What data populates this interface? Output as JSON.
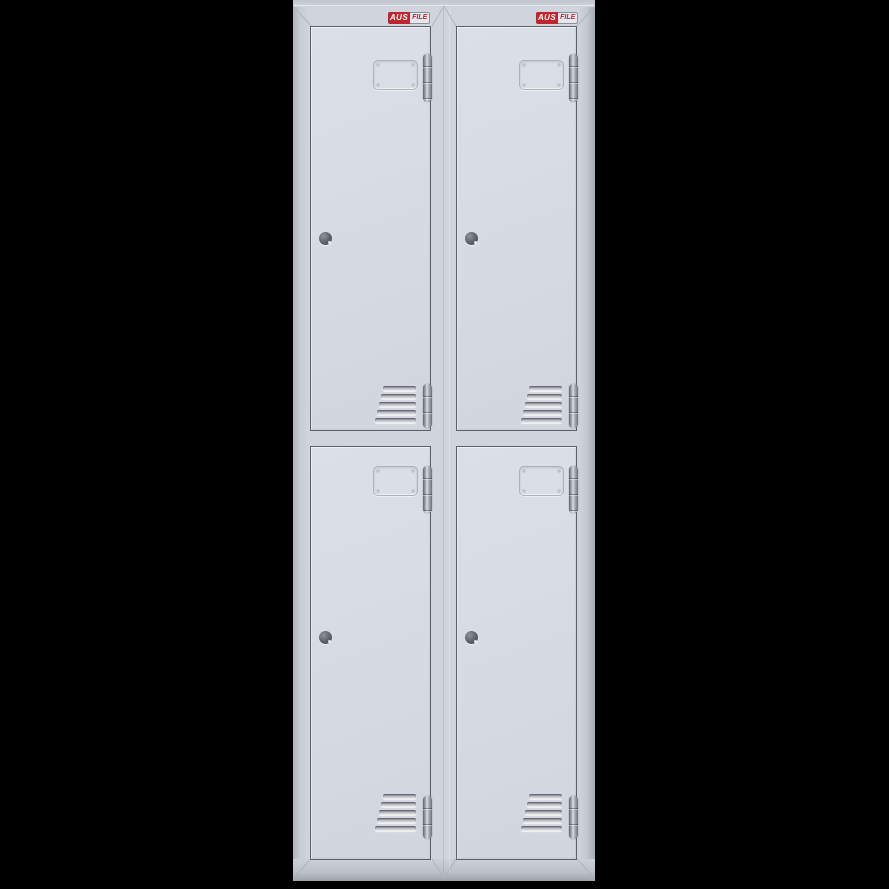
{
  "scene": {
    "type": "product-render",
    "subject": "Two-column four-door metal locker cabinet",
    "background_color": "#000000"
  },
  "brand": {
    "name": "AUSFILE",
    "aus": "AUS",
    "file": "FILE",
    "badge_red": "#c2242b",
    "badge_count": 2
  },
  "cabinet": {
    "body_color": "#d0d4dc",
    "door_color": "#d6dae2",
    "outline_color": "#5d6067",
    "hinge_color": "#9da1a8",
    "columns": 2,
    "rows": 2,
    "doors": [
      {
        "id": "top-left",
        "position": "upper left"
      },
      {
        "id": "top-right",
        "position": "upper right"
      },
      {
        "id": "bottom-left",
        "position": "lower left"
      },
      {
        "id": "bottom-right",
        "position": "lower right"
      }
    ],
    "door_features": {
      "label_holder": "recessed card holder",
      "lock": "round cam lock",
      "hinge_segments_per_door": 2,
      "vent_louvers_per_door": 5
    }
  }
}
